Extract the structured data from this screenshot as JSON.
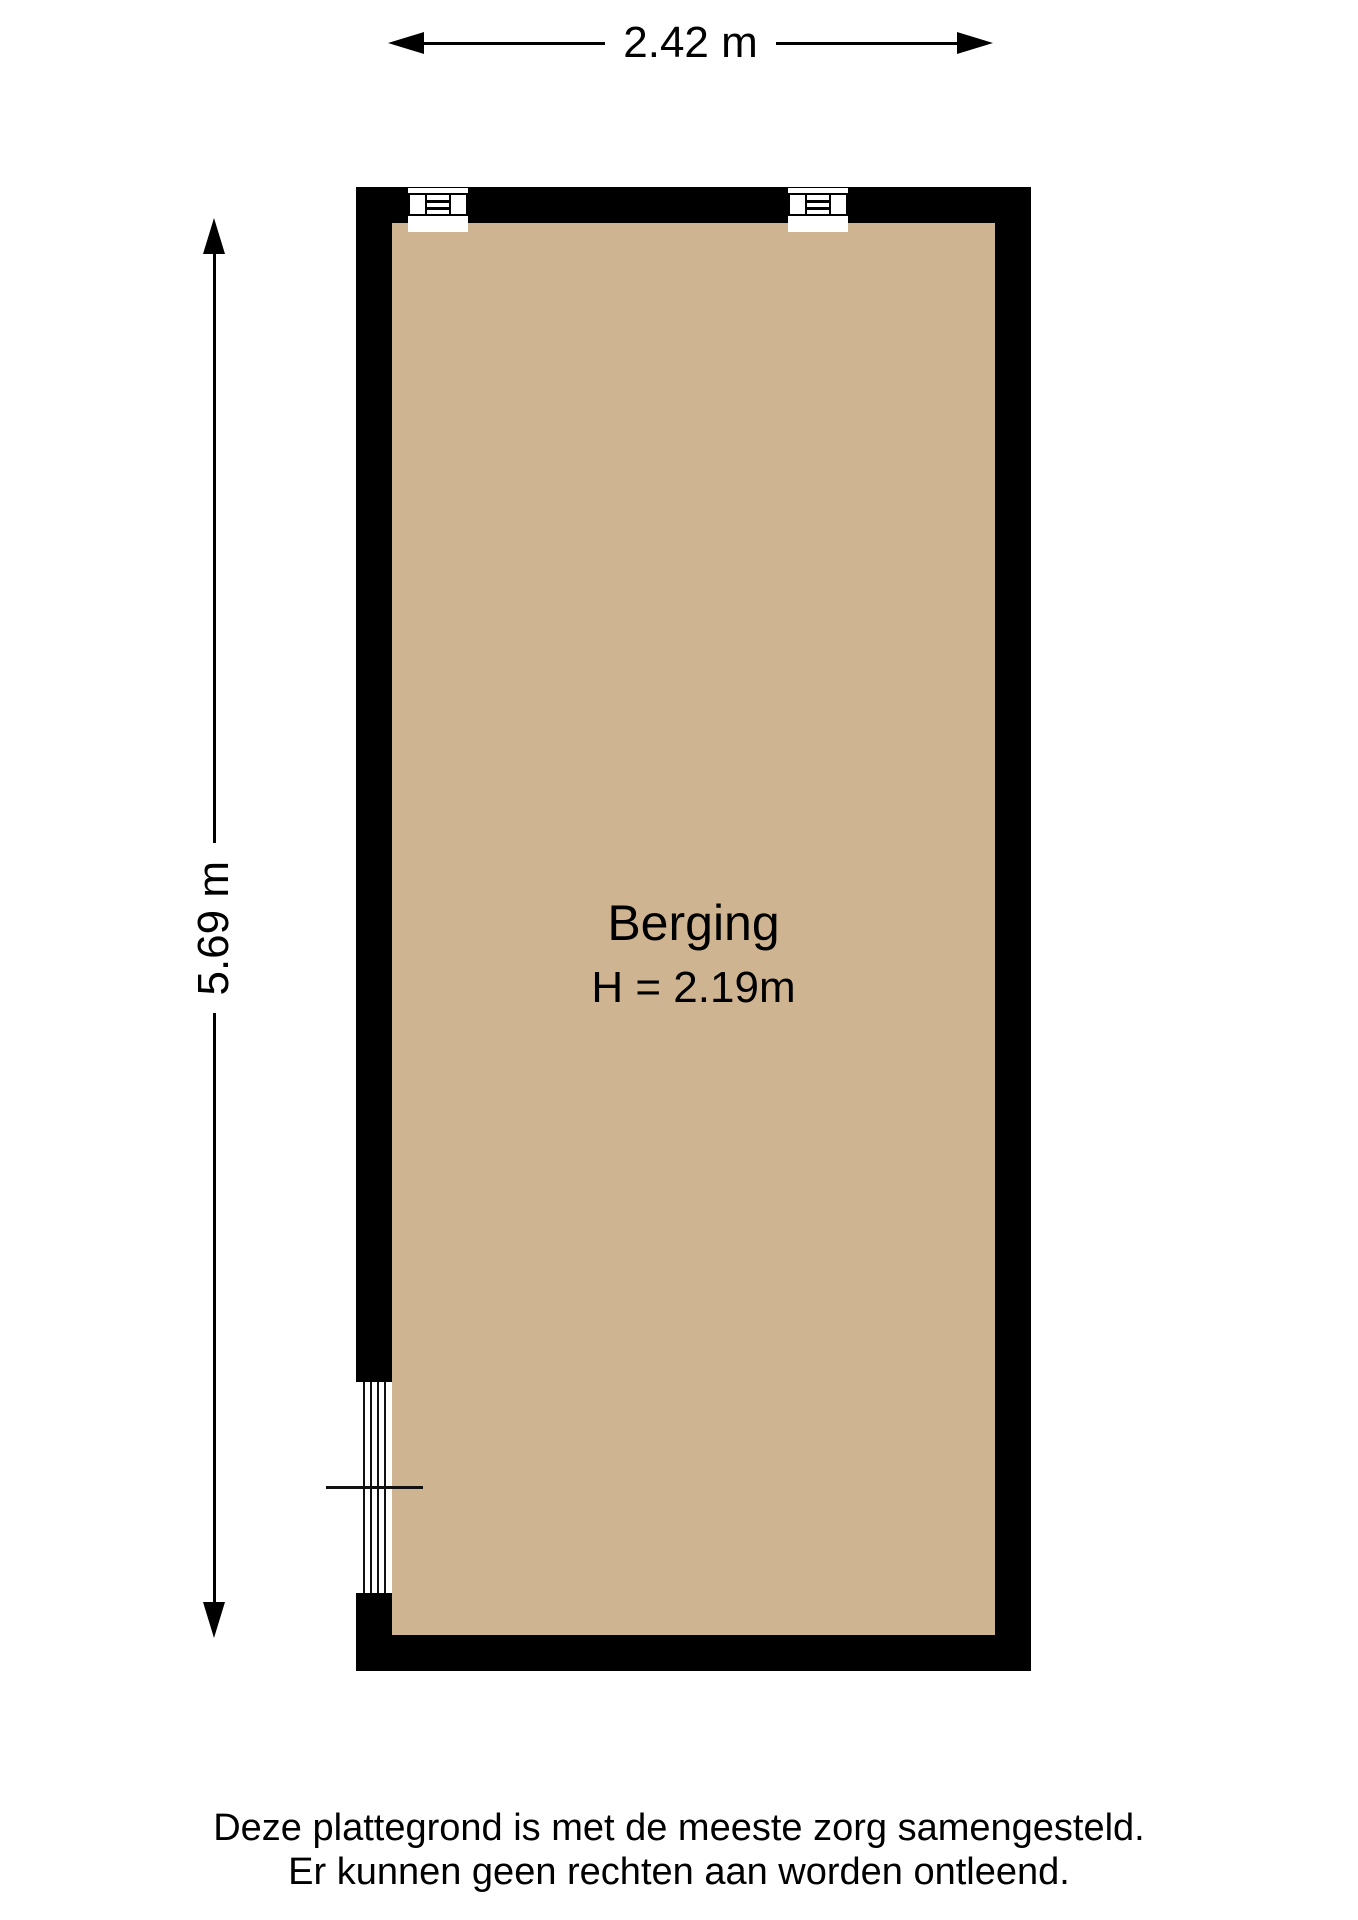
{
  "colors": {
    "wall": "#000000",
    "floor": "#ceb491",
    "line": "#111111"
  },
  "dimensions": {
    "width": {
      "label": "2.42 m"
    },
    "height": {
      "label": "5.69 m"
    }
  },
  "room": {
    "name": "Berging",
    "ceiling_height": "H = 2.19m"
  },
  "footer": {
    "line1": "Deze plattegrond is met de meeste zorg samengesteld.",
    "line2": "Er kunnen geen rechten aan worden ontleend."
  }
}
